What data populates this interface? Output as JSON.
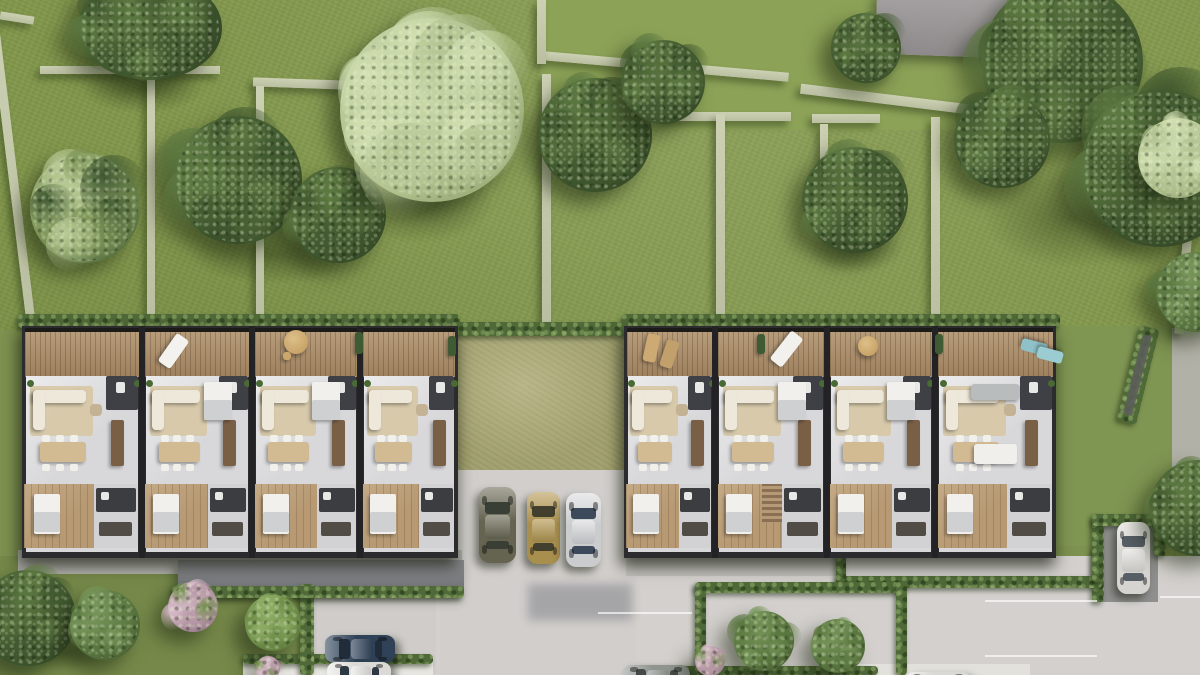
{
  "scene": {
    "w": 1200,
    "h": 675,
    "kind": "aerial-architectural-render"
  },
  "palette": {
    "grass": "#83974e",
    "grass_dim": "#76894a",
    "grass_bright": "#8ca257",
    "courtyard_lawn": "#a3a272",
    "stone_wall": "#c4c8ac",
    "hedge": "#4f6a38",
    "deck_wood": "#ab8d69",
    "frame_dark": "#221f1c",
    "floor_light": "#d8d8da",
    "wood_floor": "#b79a74",
    "core_dark": "#3e4046",
    "road": "#d3d0cd",
    "flat_roof": "#75777a",
    "patio": "#e8e6e1",
    "neighbor_roof": "#9b9799"
  },
  "lawn_patches": [
    {
      "x": 540,
      "y": 0,
      "w": 470,
      "h": 130,
      "c": "#8ca257"
    },
    {
      "x": 0,
      "y": 330,
      "w": 26,
      "h": 246,
      "c": "#7d9150"
    },
    {
      "x": 1050,
      "y": 326,
      "w": 150,
      "h": 224,
      "c": "#7f9552"
    },
    {
      "x": 0,
      "y": 556,
      "w": 322,
      "h": 119,
      "c": "#76894a"
    },
    {
      "x": 706,
      "y": 593,
      "w": 190,
      "h": 82,
      "c": "#84984f"
    },
    {
      "x": 838,
      "y": 546,
      "w": 258,
      "h": 32,
      "c": "#7d9150"
    }
  ],
  "shade_patches": [
    {
      "x": 320,
      "y": 148,
      "w": 205,
      "h": 112
    },
    {
      "x": 55,
      "y": 52,
      "w": 175,
      "h": 72
    },
    {
      "x": 155,
      "y": 212,
      "w": 235,
      "h": 85
    },
    {
      "x": 945,
      "y": 145,
      "w": 255,
      "h": 145
    },
    {
      "x": 788,
      "y": 212,
      "w": 135,
      "h": 72
    },
    {
      "x": 0,
      "y": 628,
      "w": 125,
      "h": 50
    }
  ],
  "stone_walls": [
    {
      "x": 40,
      "y": 66,
      "w": 180,
      "h": 8,
      "rot": 0
    },
    {
      "x": 253,
      "y": 79,
      "w": 93,
      "h": 9,
      "rot": 2
    },
    {
      "x": 543,
      "y": 62,
      "w": 246,
      "h": 9,
      "rot": 5
    },
    {
      "x": 663,
      "y": 112,
      "w": 128,
      "h": 9,
      "rot": 0
    },
    {
      "x": 812,
      "y": 114,
      "w": 68,
      "h": 9,
      "rot": 0
    },
    {
      "x": 800,
      "y": 94,
      "w": 170,
      "h": 10,
      "rot": 7
    },
    {
      "x": 8,
      "y": 6,
      "w": 9,
      "h": 332,
      "rot": -7
    },
    {
      "x": 0,
      "y": 14,
      "w": 34,
      "h": 8,
      "rot": 9
    },
    {
      "x": 147,
      "y": 70,
      "w": 8,
      "h": 252,
      "rot": 0
    },
    {
      "x": 256,
      "y": 86,
      "w": 8,
      "h": 238,
      "rot": 0
    },
    {
      "x": 537,
      "y": 0,
      "w": 9,
      "h": 64,
      "rot": 0
    },
    {
      "x": 542,
      "y": 74,
      "w": 9,
      "h": 250,
      "rot": 0
    },
    {
      "x": 716,
      "y": 114,
      "w": 9,
      "h": 210,
      "rot": 0
    },
    {
      "x": 931,
      "y": 117,
      "w": 9,
      "h": 212,
      "rot": 0
    },
    {
      "x": 820,
      "y": 124,
      "w": 8,
      "h": 80,
      "rot": 0
    },
    {
      "x": 1180,
      "y": 208,
      "w": 9,
      "h": 126,
      "rot": 5
    }
  ],
  "paving": [
    {
      "x": 430,
      "y": 556,
      "w": 770,
      "h": 119,
      "c": "#d3d0cd",
      "tex": true
    },
    {
      "x": 314,
      "y": 580,
      "w": 122,
      "h": 95,
      "c": "#cfccc9",
      "tex": true
    },
    {
      "x": 440,
      "y": 462,
      "w": 196,
      "h": 215,
      "c": "#d1cecb",
      "tex": true
    },
    {
      "x": 528,
      "y": 584,
      "w": 104,
      "h": 36,
      "c": "#9e9ea1",
      "blur": 5
    },
    {
      "x": 1172,
      "y": 328,
      "w": 28,
      "h": 188,
      "c": "#b2b1a7"
    },
    {
      "x": 18,
      "y": 550,
      "w": 444,
      "h": 24,
      "c": "#b5b3af"
    },
    {
      "x": 626,
      "y": 548,
      "w": 216,
      "h": 28,
      "c": "#c2c0bc"
    },
    {
      "x": 1096,
      "y": 518,
      "w": 62,
      "h": 84,
      "c": "#8f8f8d"
    },
    {
      "x": 243,
      "y": 660,
      "w": 190,
      "h": 15,
      "c": "#e8e6e1"
    },
    {
      "x": 845,
      "y": 664,
      "w": 185,
      "h": 11,
      "c": "#e3e1dc"
    }
  ],
  "roofs": [
    {
      "name": "flat-roof-garage",
      "x": 178,
      "y": 560,
      "w": 286,
      "h": 34,
      "c1": "#8b8d8f",
      "c2": "#6f7174",
      "rot": 0
    },
    {
      "name": "neighbor-roof",
      "x": 876,
      "y": -6,
      "w": 132,
      "h": 62,
      "c1": "#a6a2a3",
      "c2": "#8e8a8b",
      "rot": 2
    }
  ],
  "hedges": [
    {
      "x": 18,
      "y": 314,
      "w": 442,
      "h": 14
    },
    {
      "x": 622,
      "y": 314,
      "w": 438,
      "h": 14
    },
    {
      "x": 452,
      "y": 322,
      "w": 180,
      "h": 14
    },
    {
      "x": 1128,
      "y": 326,
      "w": 20,
      "h": 98,
      "rot": 14,
      "inner": "#5c5f5a"
    },
    {
      "x": 1092,
      "y": 514,
      "w": 12,
      "h": 88
    },
    {
      "x": 1092,
      "y": 514,
      "w": 72,
      "h": 12
    },
    {
      "x": 1154,
      "y": 514,
      "w": 12,
      "h": 42
    },
    {
      "x": 836,
      "y": 576,
      "w": 266,
      "h": 12
    },
    {
      "x": 836,
      "y": 548,
      "w": 10,
      "h": 34
    },
    {
      "x": 1092,
      "y": 548,
      "w": 10,
      "h": 34
    },
    {
      "x": 695,
      "y": 582,
      "w": 212,
      "h": 11
    },
    {
      "x": 695,
      "y": 582,
      "w": 11,
      "h": 93
    },
    {
      "x": 896,
      "y": 582,
      "w": 11,
      "h": 93
    },
    {
      "x": 640,
      "y": 666,
      "w": 238,
      "h": 9
    },
    {
      "x": 243,
      "y": 654,
      "w": 190,
      "h": 10
    },
    {
      "x": 300,
      "y": 584,
      "w": 14,
      "h": 91
    },
    {
      "x": 172,
      "y": 586,
      "w": 292,
      "h": 12
    }
  ],
  "courtyard": {
    "x": 452,
    "y": 330,
    "w": 178,
    "h": 140,
    "c": "#a3a272"
  },
  "buildings": [
    {
      "id": "block-west",
      "x": 22,
      "y": 326,
      "w": 436,
      "h": 232,
      "dividers": [
        120,
        230,
        338
      ],
      "variants": [
        0,
        1,
        1,
        0
      ],
      "stairs_unit": -1
    },
    {
      "id": "block-east",
      "x": 624,
      "y": 326,
      "w": 432,
      "h": 232,
      "dividers": [
        91,
        203,
        311
      ],
      "variants": [
        0,
        1,
        1,
        2
      ],
      "stairs_unit": 1
    }
  ],
  "unit_layout": {
    "terrace_h": 46,
    "main_y": 50,
    "main_h": 108,
    "lower_y": 158,
    "lower_h": 64,
    "colors": {
      "floor": "#d8d8da",
      "rug": "#d6c6a4",
      "sofa": "#eee8da",
      "pouf": "#c3b394",
      "island": "#7a5f47",
      "dining": "#d2ba92",
      "chair": "#f2f0ea",
      "core": "#3e4046",
      "bed": "#f1f0ed",
      "bedding": "#cfd0d2",
      "bath": "#3b3d41",
      "closet": "#514c45",
      "plant": "#4a6a35",
      "sofa_gray": "#b9bcbd"
    }
  },
  "deck_items": [
    {
      "t": "lounger",
      "x": 166,
      "y": 334,
      "w": 15,
      "h": 34,
      "rot": 35,
      "c": "#f3f2ee"
    },
    {
      "t": "round",
      "x": 296,
      "y": 342,
      "r": 12,
      "c": "#c9a468"
    },
    {
      "t": "chair",
      "x": 283,
      "y": 352,
      "w": 8,
      "h": 8,
      "c": "#caa76c"
    },
    {
      "t": "plantbox",
      "x": 355,
      "y": 332,
      "w": 8,
      "h": 22,
      "c": "#3f5b33"
    },
    {
      "t": "plantbox",
      "x": 448,
      "y": 336,
      "w": 8,
      "h": 20,
      "c": "#3f5b33"
    },
    {
      "t": "lounger",
      "x": 645,
      "y": 334,
      "w": 13,
      "h": 28,
      "rot": 12,
      "c": "#cda973"
    },
    {
      "t": "lounger",
      "x": 663,
      "y": 340,
      "w": 13,
      "h": 28,
      "rot": 18,
      "c": "#c2a06b"
    },
    {
      "t": "lounger",
      "x": 779,
      "y": 331,
      "w": 15,
      "h": 36,
      "rot": 38,
      "c": "#f2f1ed"
    },
    {
      "t": "plantbox",
      "x": 757,
      "y": 334,
      "w": 8,
      "h": 20,
      "c": "#3f5b33"
    },
    {
      "t": "round",
      "x": 868,
      "y": 346,
      "r": 10,
      "c": "#c9a468"
    },
    {
      "t": "lounger",
      "x": 1028,
      "y": 334,
      "w": 12,
      "h": 26,
      "rot": 105,
      "c": "#8ec2c8"
    },
    {
      "t": "lounger",
      "x": 1044,
      "y": 342,
      "w": 12,
      "h": 26,
      "rot": 105,
      "c": "#9accd1"
    },
    {
      "t": "plantbox",
      "x": 935,
      "y": 334,
      "w": 8,
      "h": 20,
      "c": "#3f5b33"
    }
  ],
  "trees": [
    {
      "x": 150,
      "y": 28,
      "r": 78,
      "ry": 56,
      "tone": "dark"
    },
    {
      "x": 85,
      "y": 208,
      "r": 60,
      "tone": "mixed"
    },
    {
      "x": 238,
      "y": 180,
      "r": 70,
      "tone": "dark"
    },
    {
      "x": 338,
      "y": 215,
      "r": 52,
      "tone": "dark"
    },
    {
      "x": 432,
      "y": 110,
      "r": 100,
      "tone": "light"
    },
    {
      "x": 595,
      "y": 135,
      "r": 62,
      "tone": "dark"
    },
    {
      "x": 663,
      "y": 82,
      "r": 46,
      "tone": "dark"
    },
    {
      "x": 866,
      "y": 48,
      "r": 38,
      "tone": "dark"
    },
    {
      "x": 855,
      "y": 200,
      "r": 58,
      "tone": "dark"
    },
    {
      "x": 1062,
      "y": 62,
      "r": 88,
      "tone": "dark"
    },
    {
      "x": 1160,
      "y": 168,
      "r": 86,
      "tone": "dark"
    },
    {
      "x": 1002,
      "y": 140,
      "r": 52,
      "tone": "dark"
    },
    {
      "x": 1178,
      "y": 158,
      "r": 44,
      "tone": "light"
    },
    {
      "x": 1196,
      "y": 292,
      "r": 44,
      "tone": "mid"
    },
    {
      "x": 1198,
      "y": 508,
      "r": 52,
      "tone": "dark"
    },
    {
      "x": 28,
      "y": 618,
      "r": 52,
      "tone": "dark"
    },
    {
      "x": 105,
      "y": 625,
      "r": 38,
      "tone": "mid"
    },
    {
      "x": 193,
      "y": 607,
      "r": 27,
      "tone": "pink"
    },
    {
      "x": 273,
      "y": 623,
      "r": 30,
      "tone": "midlight"
    },
    {
      "x": 268,
      "y": 668,
      "r": 13,
      "tone": "pink"
    },
    {
      "x": 764,
      "y": 641,
      "r": 33,
      "tone": "mid"
    },
    {
      "x": 838,
      "y": 646,
      "r": 29,
      "tone": "mid"
    },
    {
      "x": 710,
      "y": 661,
      "r": 16,
      "tone": "pink"
    }
  ],
  "cars": [
    {
      "name": "car-olive",
      "x": 479,
      "y": 487,
      "w": 37,
      "h": 76,
      "o": "v",
      "body": "#6e6c58",
      "glass": "#3a3f36"
    },
    {
      "name": "car-gold",
      "x": 527,
      "y": 492,
      "w": 33,
      "h": 72,
      "o": "v",
      "body": "#b79b55",
      "glass": "#423f2e"
    },
    {
      "name": "car-silver",
      "x": 566,
      "y": 493,
      "w": 35,
      "h": 74,
      "o": "v",
      "body": "#dcdde0",
      "glass": "#3c4a5c"
    },
    {
      "name": "car-darkblue",
      "x": 325,
      "y": 593,
      "w": 70,
      "h": 28,
      "o": "h",
      "body": "#33475e",
      "glass": "#202c3a"
    },
    {
      "name": "car-white-1",
      "x": 327,
      "y": 626,
      "w": 64,
      "h": 28,
      "o": "h",
      "body": "#ecebe8",
      "glass": "#2e3744"
    },
    {
      "name": "car-gray",
      "x": 622,
      "y": 627,
      "w": 68,
      "h": 30,
      "o": "h",
      "body": "#9ba19b",
      "glass": "#434a47"
    },
    {
      "name": "car-white-2",
      "x": 905,
      "y": 636,
      "w": 66,
      "h": 30,
      "o": "h",
      "body": "#eceae6",
      "glass": "#23282e"
    },
    {
      "name": "car-white-3",
      "x": 1117,
      "y": 522,
      "w": 33,
      "h": 72,
      "o": "v",
      "body": "#e8e6e2",
      "glass": "#565e66"
    }
  ],
  "road_lines": [
    {
      "x": 20,
      "y": 608,
      "w": 72,
      "h": 2
    },
    {
      "x": 598,
      "y": 612,
      "w": 94,
      "h": 2
    },
    {
      "x": 985,
      "y": 600,
      "w": 112,
      "h": 2
    },
    {
      "x": 985,
      "y": 655,
      "w": 112,
      "h": 2
    },
    {
      "x": 1160,
      "y": 596,
      "w": 40,
      "h": 2
    }
  ]
}
